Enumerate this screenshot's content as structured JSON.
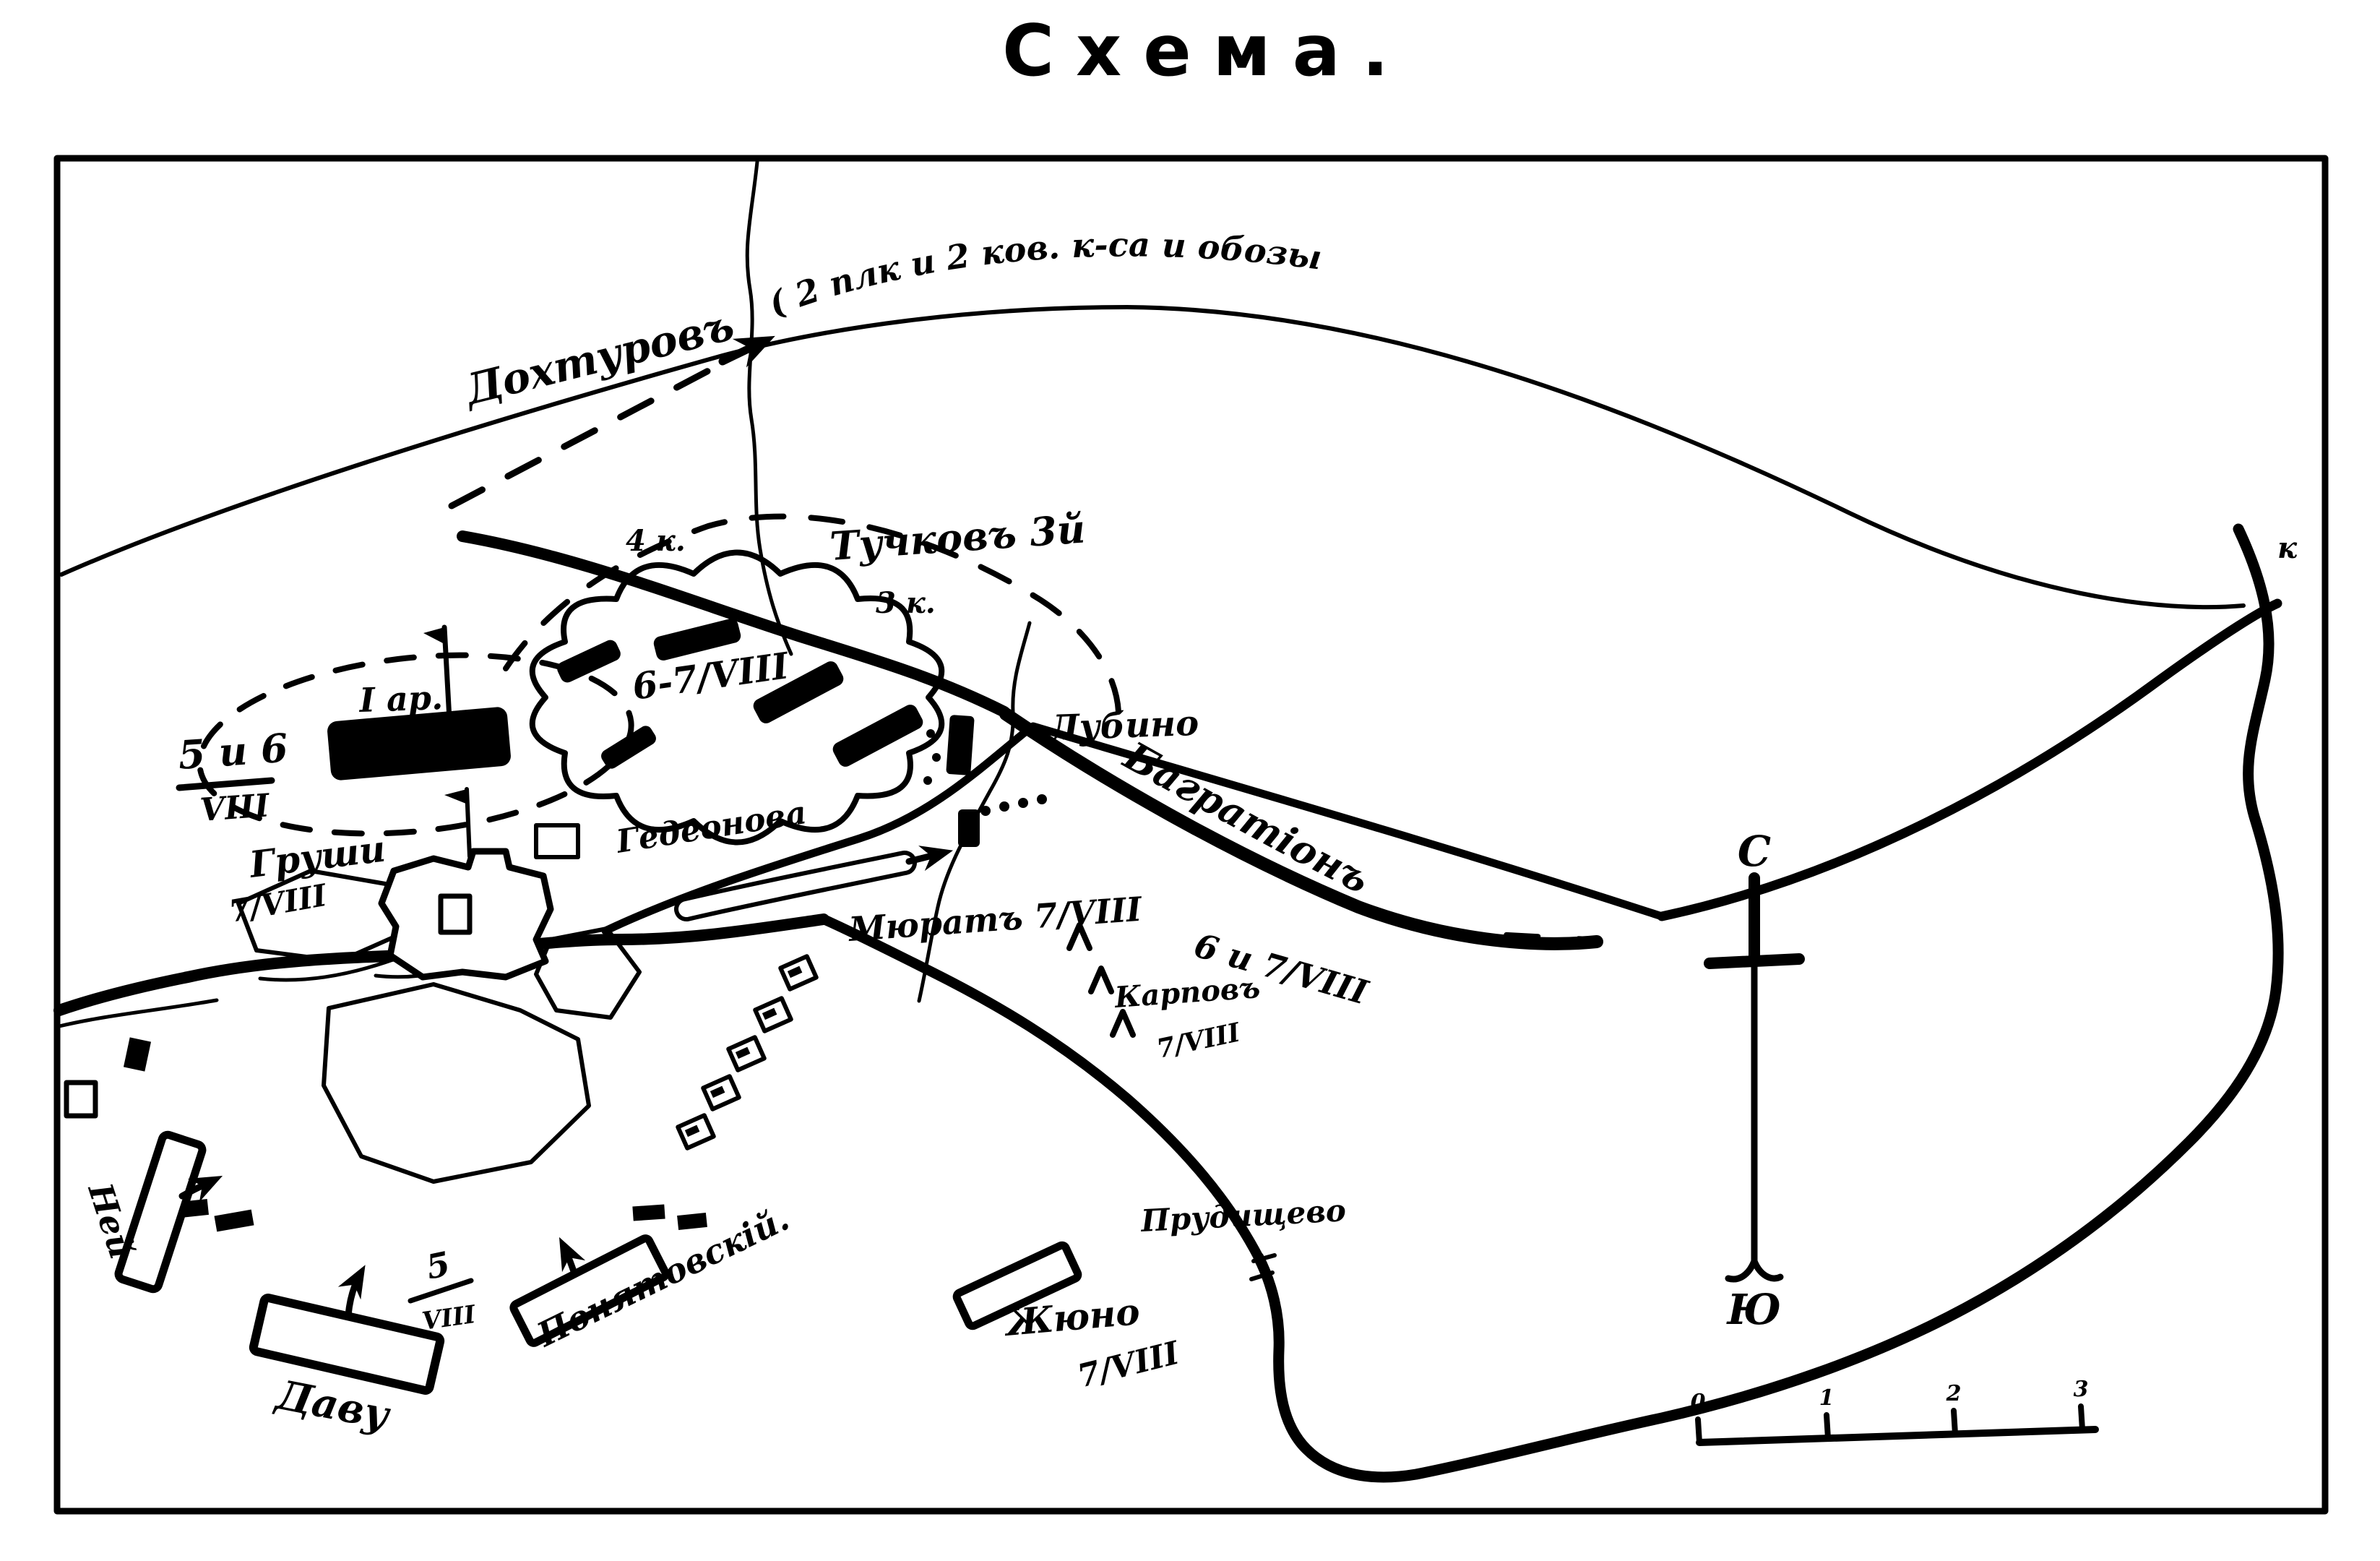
{
  "title": "Схема.",
  "colors": {
    "ink": "#000000",
    "paper": "#ffffff"
  },
  "map": {
    "annotation_route": "( 2 плк и 2 ков. к-са и обозы",
    "commanders": {
      "dokhturov": "Дохтуровъ",
      "tuchkov": "Тучковъ 3й",
      "bagration": "Багратіонъ",
      "grouchy": "Груши",
      "murat": "Мюратъ 7/VIII",
      "karpov": "Карповъ",
      "ney": "Ней",
      "davout": "Даву",
      "poniatowski": "Понятовскій.",
      "junot": "Жюно"
    },
    "places": {
      "lubino": "Лубино",
      "gedeonovo": "Гедеонова",
      "prudishchevo": "Прудищево"
    },
    "units": {
      "corps4": "4 к.",
      "corps3": "3 к.",
      "army1": "I ар."
    },
    "dates": {
      "woods": "6-7/VIII",
      "pos56_num": "5 и 6",
      "pos56_den": "VIII",
      "grouchy_date": "7/VIII",
      "karpov_upper": "6 и 7/VIII",
      "karpov_lower": "7/VIII",
      "davout_num": "5",
      "davout_den": "VIII",
      "junot_date": "7/VIII"
    },
    "compass": {
      "north": "С",
      "south": "Ю"
    },
    "edge_label": "к",
    "scale_ticks": [
      "0",
      "1",
      "2",
      "3"
    ]
  }
}
